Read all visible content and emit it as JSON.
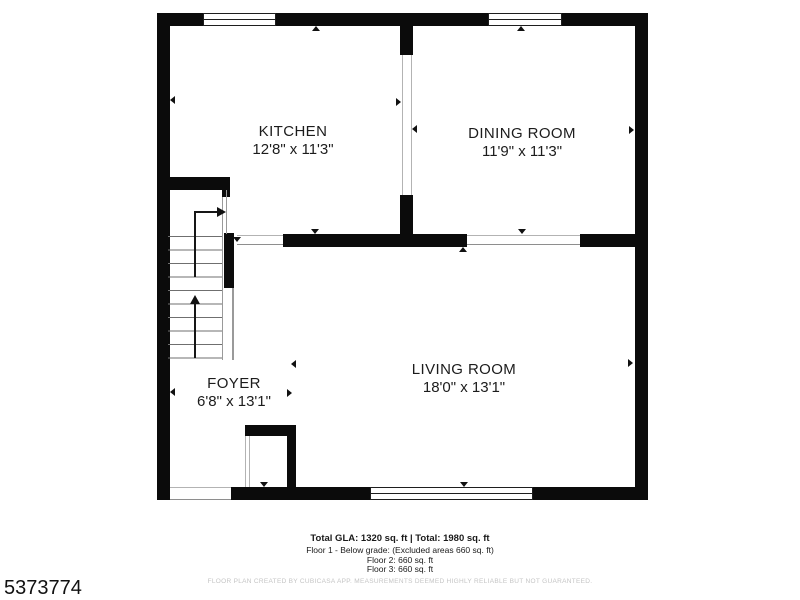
{
  "plan": {
    "rooms": [
      {
        "name": "KITCHEN",
        "dims": "12'8\" x 11'3\""
      },
      {
        "name": "DINING ROOM",
        "dims": "11'9\" x 11'3\""
      },
      {
        "name": "LIVING ROOM",
        "dims": "18'0\" x 13'1\""
      },
      {
        "name": "FOYER",
        "dims": "6'8\" x 13'1\""
      }
    ]
  },
  "footer": {
    "total_line": "Total GLA: 1320 sq. ft | Total: 1980 sq. ft",
    "floor_lines": [
      "Floor 1 - Below grade: (Excluded areas 660 sq. ft)",
      "Floor 2: 660 sq. ft",
      "Floor 3: 660 sq. ft"
    ],
    "disclaimer": "FLOOR PLAN CREATED BY CUBICASA APP. MEASUREMENTS DEEMED HIGHLY RELIABLE BUT NOT GUARANTEED."
  },
  "listing_id": "5373774",
  "colors": {
    "wall": "#0b0b0b",
    "background": "#ffffff"
  }
}
